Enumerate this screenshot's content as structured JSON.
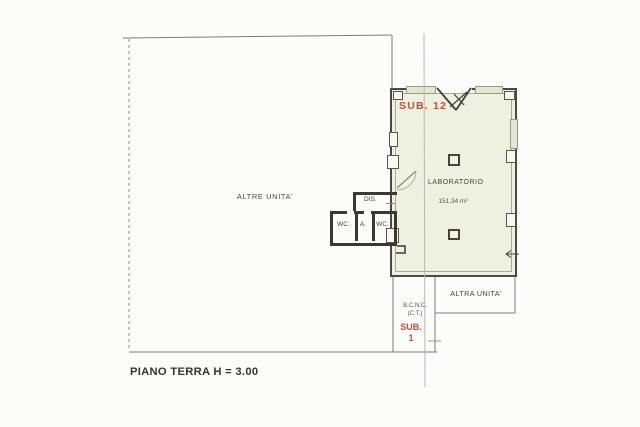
{
  "page": {
    "title": "PIANO TERRA H = 3.00"
  },
  "plan": {
    "altre_unita_label": "ALTRE UNITA'",
    "laboratorio": {
      "sub_label": "SUB. 12",
      "name": "LABORATORIO",
      "area": "151,34 m²"
    },
    "service_rooms": {
      "dis": "DIS.",
      "wc_left": "WC.",
      "anti": "A.",
      "wc_right": "WC."
    },
    "bcnc": {
      "line1": "B.C.N.C.",
      "line2": "(C.T.)",
      "sub_label": "SUB.",
      "sub_number": "1"
    },
    "altra_unita_label": "ALTRA UNITA'",
    "colors": {
      "red_accent": "#d04a3a",
      "wall": "#43433a",
      "floor_fill": "#eef0e0",
      "thin_line": "#7d7d73"
    }
  }
}
